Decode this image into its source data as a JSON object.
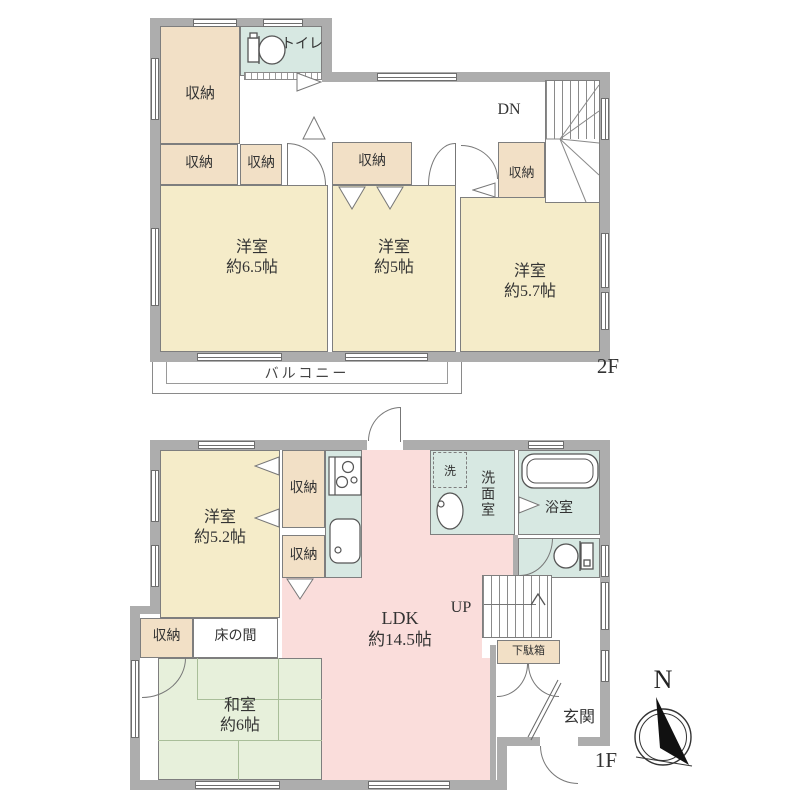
{
  "colors": {
    "wall": "#ADADAD",
    "room_yellow": "#F5ECC9",
    "closet_tan": "#F2E0C6",
    "water_cyan": "#D7E8E2",
    "ldk_pink": "#FADDDB",
    "tatami_green": "#E7F0DB",
    "tatami_line": "#A9BE99",
    "text": "#333333"
  },
  "f2": {
    "floor_label": "2F",
    "balcony_label": "バルコニー",
    "stairs_label": "DN",
    "toilet_label": "トイレ",
    "closet_main": "収納",
    "closet_a": "収納",
    "closet_b": "収納",
    "closet_c": "収納",
    "closet_d": "収納",
    "room1_name": "洋室",
    "room1_size": "約6.5帖",
    "room2_name": "洋室",
    "room2_size": "約5帖",
    "room3_name": "洋室",
    "room3_size": "約5.7帖"
  },
  "f1": {
    "floor_label": "1F",
    "stairs_label": "UP",
    "room_west_name": "洋室",
    "room_west_size": "約5.2帖",
    "closet_a": "収納",
    "closet_b": "収納",
    "closet_c": "収納",
    "washer_label": "洗",
    "washroom_label": "洗面室",
    "bath_label": "浴室",
    "ldk_name": "LDK",
    "ldk_size": "約14.5帖",
    "tokonoma_label": "床の間",
    "shoebox_label": "下駄箱",
    "genkan_label": "玄関",
    "washitsu_name": "和室",
    "washitsu_size": "約6帖"
  },
  "compass": {
    "north_label": "N"
  }
}
